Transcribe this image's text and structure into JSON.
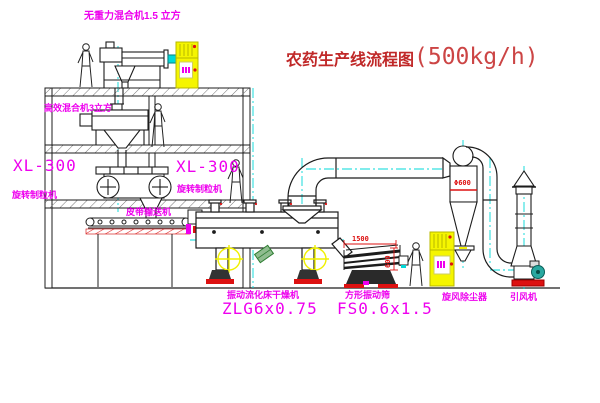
{
  "title": {
    "name_cn": "农药生产线流程图",
    "capacity": "(500kg/h)"
  },
  "labels": {
    "mixer_top": "无重力混合机1.5 立方",
    "mixer_mid": "高效混合机3立方",
    "granulator_left_model": "XL-300",
    "granulator_left_name": "旋转制粒机",
    "granulator_right_model": "XL-300",
    "granulator_right_name": "旋转制粒机",
    "belt_conveyor": "皮带输送机",
    "dryer_name": "振动流化床干燥机",
    "dryer_model": "ZLG6x0.75",
    "screen_name": "方形振动筛",
    "screen_model": "FS0.6x1.5",
    "cyclone_name": "旋风除尘器",
    "fan_name": "引风机"
  },
  "dimensions": {
    "screen_length": "1500",
    "screen_width": "600",
    "cyclone_diameter": "Φ600"
  },
  "colors": {
    "magenta": "#ee00ee",
    "red": "#dd1111",
    "yellow": "#f5f500",
    "cyan": "#00d8d8",
    "teal": "#29a8a0",
    "line": "#1c1c1c",
    "title_red": "#c02828"
  }
}
